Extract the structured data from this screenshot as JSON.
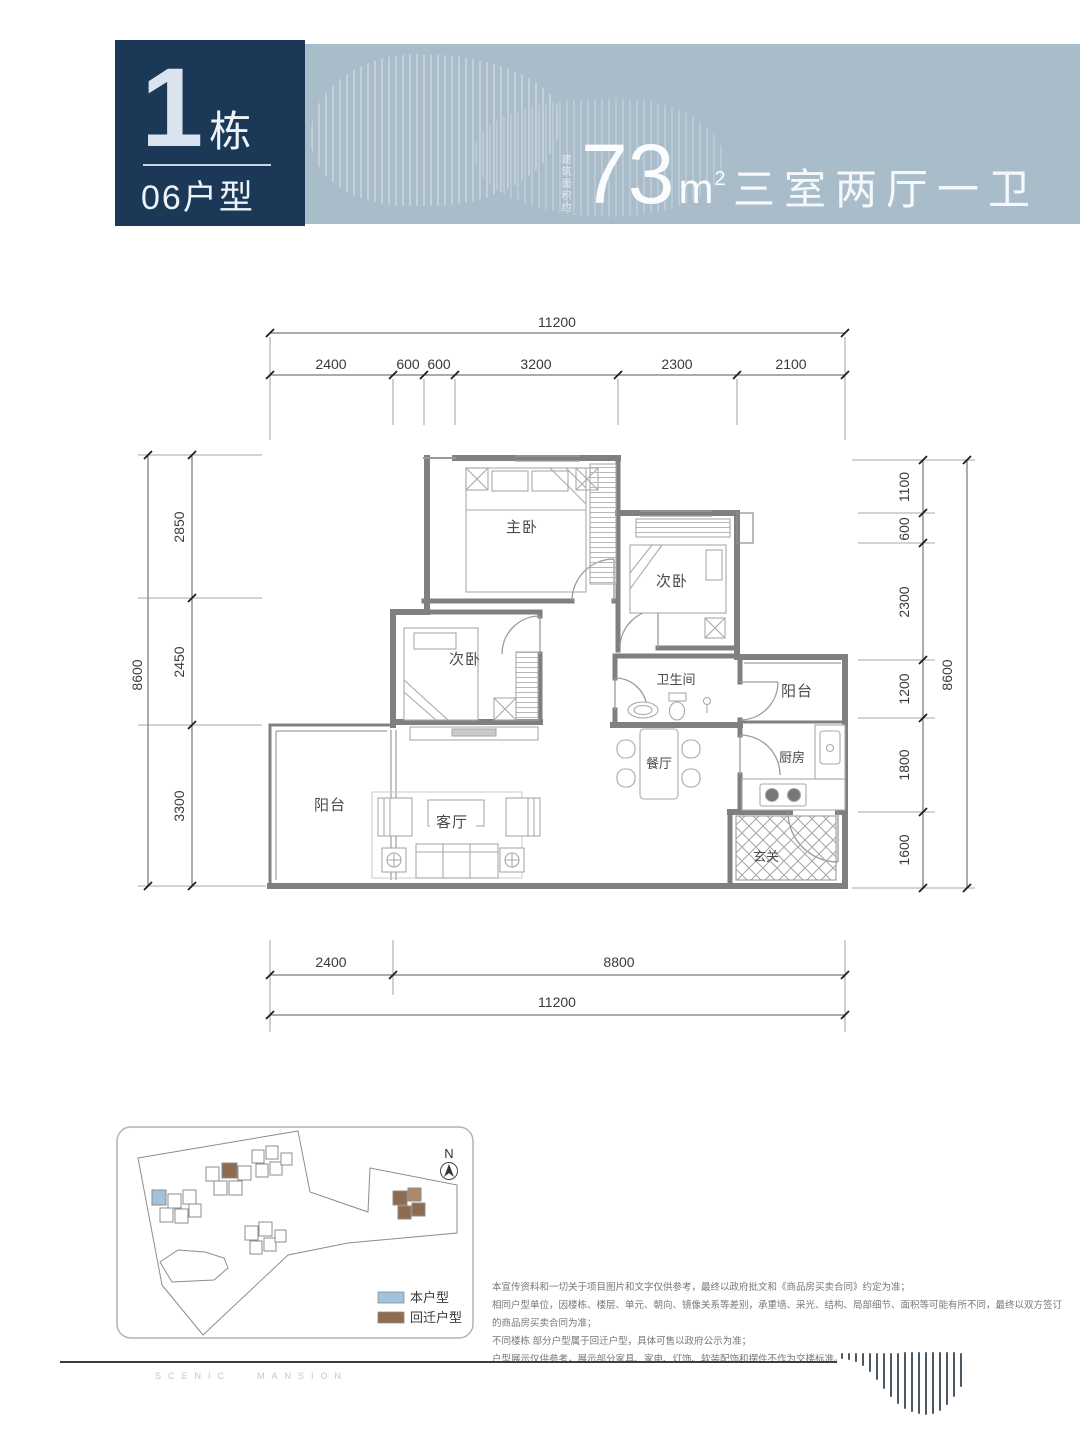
{
  "header": {
    "building_number": "1",
    "building_suffix": "栋",
    "unit_code": "06户型",
    "area_prefix": "建筑面积约",
    "area_value": "73",
    "area_unit_base": "m",
    "area_unit_sup": "2",
    "layout_summary": "三室两厅一卫",
    "colors": {
      "navy": "#1c3857",
      "band": "#a9bcca"
    }
  },
  "floor_plan": {
    "rooms": {
      "master": "主卧",
      "bedroom2": "次卧",
      "bedroom3": "次卧",
      "bathroom": "卫生间",
      "balcony_right": "阳台",
      "dining": "餐厅",
      "kitchen": "厨房",
      "living": "客厅",
      "balcony_left": "阳台",
      "foyer": "玄关"
    },
    "dimensions": {
      "top": {
        "total": "11200",
        "segs": [
          "2400",
          "600",
          "600",
          "3200",
          "2300",
          "2100"
        ]
      },
      "bottom": {
        "total": "11200",
        "segs": [
          "2400",
          "8800"
        ]
      },
      "left": {
        "total": "8600",
        "segs": [
          "2850",
          "2450",
          "3300"
        ]
      },
      "right": {
        "total": "8600",
        "segs": [
          "1100",
          "600",
          "2300",
          "1200",
          "1800",
          "1600"
        ]
      }
    }
  },
  "site_plan": {
    "north_label": "N",
    "legend": [
      {
        "label": "本户型",
        "color": "#9fc3dc"
      },
      {
        "label": "回迁户型",
        "color": "#8f6b50"
      }
    ]
  },
  "disclaimer": {
    "lines": [
      "本宣传资料和一切关于项目图片和文字仅供参考，最终以政府批文和《商品房买卖合同》约定为准；",
      "相同户型单位，因楼栋、楼层、单元、朝向、镜像关系等差别，承重墙、采光、结构、局部细节、面积等可能有所不同，最终以双方签订的商品房买卖合同为准；",
      "不同楼栋 部分户型属于回迁户型，具体可售以政府公示为准；",
      "户型展示仅供参考，展示部分家具、家电、灯饰、软装配饰和摆件不作为交楼标准。"
    ]
  },
  "footer": {
    "watermark_left": "SCENIC",
    "watermark_right": "MANSION"
  }
}
